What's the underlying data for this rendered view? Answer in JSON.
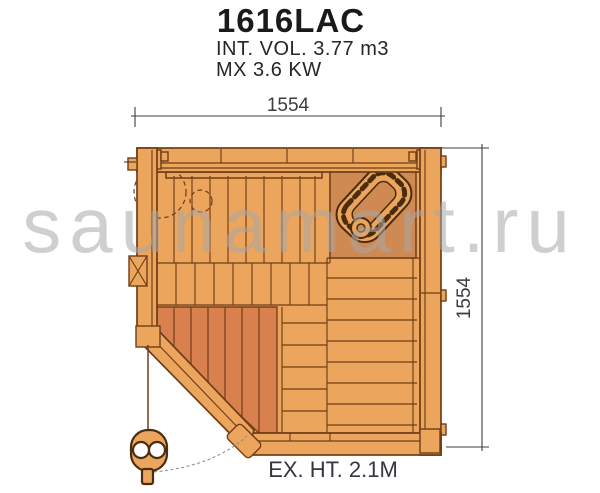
{
  "header": {
    "model": "1616LAC",
    "volume": "INT. VOL. 3.77 m3",
    "power": "MX 3.6 KW"
  },
  "plan": {
    "width_dim": "1554",
    "height_dim": "1554",
    "exterior_height": "EX. HT. 2.1M"
  },
  "watermark": "saunamart.ru",
  "colors": {
    "wood": "#EBA55C",
    "wood-dark": "#CE8A52",
    "floor-red": "#D8814E",
    "outline": "#6F3D16",
    "outline-strong": "#4A2C10",
    "red-outline": "#7A431C",
    "dim-line": "#3C3C3C",
    "text": "#1A1A1A",
    "label": "#35363E",
    "watermark-gray": "#A8A8A8"
  }
}
